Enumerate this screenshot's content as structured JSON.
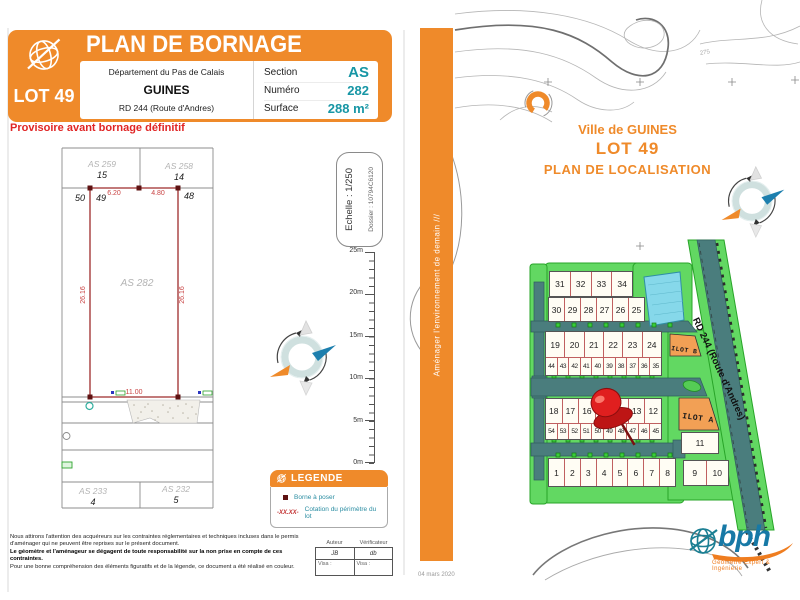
{
  "left_panel": {
    "lot_badge": "LOT 49",
    "title": "PLAN DE BORNAGE",
    "provisional_note": "Provisoire avant bornage définitif",
    "info": {
      "departement": "Département du Pas de Calais",
      "commune": "GUINES",
      "road": "RD 244 (Route d'Andres)",
      "fields": [
        {
          "label": "Section",
          "value": "AS"
        },
        {
          "label": "Numéro",
          "value": "282"
        },
        {
          "label": "Surface",
          "value": "288 m²"
        }
      ]
    },
    "drawing": {
      "parcels": {
        "as259": "AS 259",
        "as258": "AS 258",
        "as282": "AS 282",
        "as233": "AS 233",
        "as232": "AS 232"
      },
      "points": {
        "p15": "15",
        "p14": "14",
        "p50": "50",
        "p49": "49",
        "p48": "48",
        "p4": "4",
        "p5": "5"
      },
      "dims": {
        "top_left": "6.20",
        "top_right": "4.80",
        "left_side": "26.16",
        "right_side": "26.16",
        "bottom": "11.00"
      }
    },
    "scale_box": {
      "echelle": "Echelle : 1/250",
      "dossier": "Dossier : 10794C6120"
    },
    "ruler": {
      "ticks": [
        "25m",
        "20m",
        "15m",
        "10m",
        "5m",
        "0m"
      ]
    },
    "legend": {
      "title": "LEGENDE",
      "items": [
        {
          "symbol": "borne-square-icon",
          "label": "Borne à poser"
        },
        {
          "symbol": "-XX.XX-",
          "label": "Cotation du périmètre du lot"
        }
      ]
    },
    "footer": {
      "para1": "Nous attirons l'attention des acquéreurs sur les contraintes réglementaires et techniques incluses dans le permis d'aménager qui ne peuvent être reprises sur le présent document.",
      "para2": "Le géomètre et l'aménageur se dégagent de toute responsabilité sur la non prise en compte de ces contraintes.",
      "para3": "Pour une bonne compréhension des éléments figuratifs et de la légende, ce document a été réalisé en couleur.",
      "table": {
        "headers": [
          "Auteur",
          "Vérificateur"
        ],
        "values": [
          "JB",
          "db"
        ],
        "visa": [
          "Visa :",
          "Visa :"
        ]
      }
    }
  },
  "divider": {
    "slogan": "Aménager l'environnement de demain ///",
    "date": "04 mars 2020"
  },
  "right_panel": {
    "title_line1": "Ville de GUINES",
    "title_line2": "LOT 49",
    "title_line3": "PLAN DE LOCALISATION",
    "road_label": "RD 244 (Route d'Andres)",
    "contour_label": "275",
    "ilot_a": "ILOT A",
    "ilot_b": "ILOT B",
    "lot_rows": {
      "row_top": [
        "31",
        "32",
        "33",
        "34"
      ],
      "row2": [
        "30",
        "29",
        "28",
        "27",
        "26",
        "25"
      ],
      "row3": [
        "19",
        "20",
        "21",
        "22",
        "23",
        "24"
      ],
      "row4": [
        "44",
        "43",
        "42",
        "41",
        "40",
        "39",
        "38",
        "37",
        "36",
        "35"
      ],
      "row5": [
        "18",
        "17",
        "16",
        "15",
        "14",
        "13",
        "12"
      ],
      "row6": [
        "54",
        "53",
        "52",
        "51",
        "50",
        "49",
        "48",
        "47",
        "46",
        "45"
      ],
      "row_bottom": [
        "1",
        "2",
        "3",
        "4",
        "5",
        "6",
        "7",
        "8"
      ],
      "row_right": [
        "9",
        "10"
      ],
      "lot11": "11"
    },
    "logo": {
      "text": "bph",
      "tagline": "Géomètre Expert & Ingénierie"
    }
  }
}
